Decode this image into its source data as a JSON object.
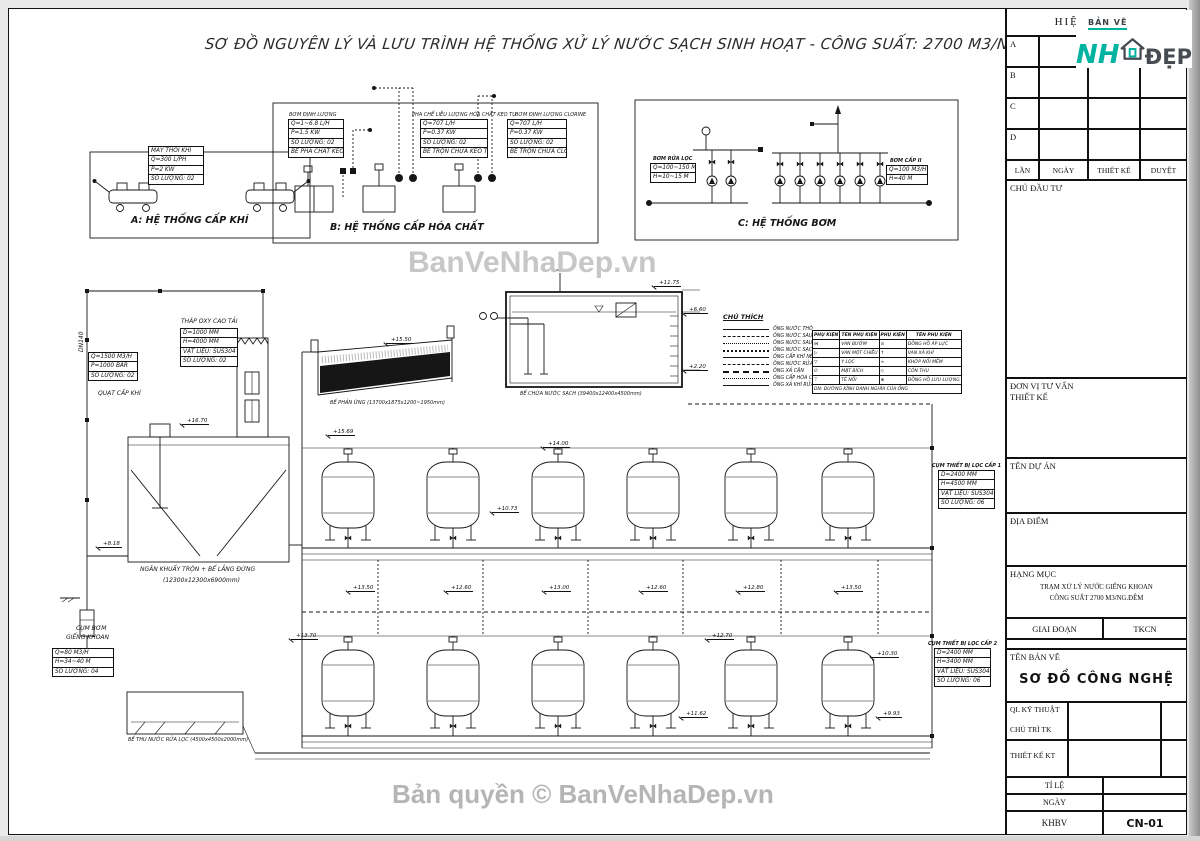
{
  "title": "SƠ ĐỒ NGUYÊN LÝ VÀ LƯU TRÌNH HỆ THỐNG XỬ LÝ NƯỚC SẠCH SINH HOẠT - CÔNG SUẤT: 2700 M3/NGÀY.ĐÊM",
  "watermarks": {
    "center": "BanVeNhaDep.vn",
    "bottom": "Bản quyền © BanVeNhaDep.vn"
  },
  "diagram_a": {
    "caption": "A: HỆ THỐNG CẤP KHÍ",
    "spec": [
      "MÁY THỔI KHÍ",
      "Q=300 L/PH",
      "P=2 KW",
      "SỐ LƯỢNG: 02"
    ]
  },
  "diagram_b": {
    "caption": "B: HỆ THỐNG CẤP HÓA CHẤT",
    "unit1_title": "BƠM ĐỊNH LƯỢNG",
    "unit1": [
      "Q=1~6.8 L/H",
      "P=1.5 KW",
      "SỐ LƯỢNG: 02",
      "BỂ PHA CHẤT KEO TỤ"
    ],
    "unit2_title": "PHA CHẾ LIỀU LƯỢNG HÓA CHẤT KEO TỤ",
    "unit2": [
      "Q=707 L/H",
      "P=0.37 KW",
      "SỐ LƯỢNG: 02",
      "BỂ TRỘN CHỨA KEO TỤ"
    ],
    "unit3_title": "BƠM ĐỊNH LƯỢNG CLORINE",
    "unit3": [
      "Q=707 L/H",
      "P=0.37 KW",
      "SỐ LƯỢNG: 02",
      "BỂ TRỘN CHỨA CLORINE"
    ]
  },
  "diagram_c": {
    "caption": "C: HỆ THỐNG BƠM",
    "left_title": "BƠM RỬA LỌC",
    "left_spec": [
      "Q=100~150 M3/H",
      "H=10~15 M"
    ],
    "right_title": "BƠM CẤP II",
    "right_spec": [
      "Q=100 M3/H",
      "H=40 M"
    ]
  },
  "tower": {
    "label": "THÁP OXY CAO TẢI",
    "spec": [
      "D=1000 MM",
      "H=4000 MM",
      "VẬT LIỆU: SUS304",
      "SỐ LƯỢNG: 02"
    ]
  },
  "fan": {
    "label": "QUẠT CẤP KHÍ",
    "spec": [
      "Q=1500 M3/H",
      "P=1000 BAR",
      "SỐ LƯỢNG: 02"
    ]
  },
  "pipe_dn": "DN140",
  "mixer": {
    "label": "NGĂN KHUẤY TRỘN + BỂ LẮNG ĐỨNG",
    "dims": "(12300x12300x6900mm)"
  },
  "well": {
    "label1": "CỤM BƠM",
    "label2": "GIẾNG KHOAN",
    "spec": [
      "Q=80 M3/H",
      "H=34~40 M",
      "SỐ LƯỢNG: 04"
    ]
  },
  "trough": {
    "label": "BỂ PHẢN ỨNG (13700x1875x1200~1950mm)"
  },
  "clean_tank": {
    "label": "BỂ CHỨA NƯỚC SẠCH (39400x12400x4500mm)"
  },
  "wash_basin": {
    "label": "BỂ THU NƯỚC RỬA LỌC (4500x4500x2000mm)"
  },
  "legend": {
    "title": "CHÚ THÍCH",
    "items": [
      "ỐNG NƯỚC THÔ",
      "ỐNG NƯỚC SAU LÀM THOÁNG",
      "ỐNG NƯỚC SAU LẮNG",
      "ỐNG NƯỚC SẠCH SAU LỌC",
      "ỐNG CẤP KHÍ NÉN",
      "ỐNG NƯỚC RỬA LỌC",
      "ỐNG XẢ CẶN",
      "ỐNG CẤP HÓA CHẤT",
      "ỐNG XẢ KHÍ RỬA LỌC"
    ]
  },
  "fittings": {
    "headers": [
      "PHỤ KIỆN",
      "TÊN PHỤ KIỆN",
      "PHỤ KIỆN",
      "TÊN PHỤ KIỆN"
    ],
    "rows": [
      [
        "⋈",
        "VAN BƯỚM",
        "⊙",
        "ĐỒNG HỒ ÁP LỰC"
      ],
      [
        "▷",
        "VAN MỘT CHIỀU",
        "↑",
        "VAN XẢ KHÍ"
      ],
      [
        "▽",
        "Y LỌC",
        "≈",
        "KHỚP NỐI MỀM"
      ],
      [
        "∅",
        "MẶT BÍCH",
        "◇",
        "CÔN THU"
      ],
      [
        "⊤",
        "TÊ NỐI",
        "⊗",
        "ĐỒNG HỒ LƯU LƯỢNG"
      ]
    ],
    "note": "DN: ĐƯỜNG KÍNH DANH NGHĨA CỦA ỐNG"
  },
  "cluster1": {
    "label": "CỤM THIẾT BỊ LỌC CẤP 1",
    "spec": [
      "D=2400 MM",
      "H=4500 MM",
      "VẬT LIỆU: SUS304",
      "SỐ LƯỢNG: 06"
    ]
  },
  "cluster2": {
    "label": "CỤM THIẾT BỊ LỌC CẤP 2",
    "spec": [
      "D=2400 MM",
      "H=3400 MM",
      "VẬT LIỆU: SUS304",
      "SỐ LƯỢNG: 06"
    ]
  },
  "markers": [
    "+11.75",
    "+6.60",
    "+2.20",
    "+15.50",
    "+16.70",
    "+15.69",
    "+8.18",
    "+14.00",
    "+10.73",
    "+13.50",
    "+12.60",
    "+13.00",
    "+12.60",
    "+12.80",
    "+13.50",
    "+13.70",
    "+12.70",
    "+10.30",
    "+11.62",
    "+9.93"
  ],
  "titleblock": {
    "revision_header": "HIỆU CHỈNH",
    "rows": [
      "A",
      "B",
      "C",
      "D"
    ],
    "cols": [
      "LẦN",
      "NGÀY",
      "THIẾT KẾ",
      "DUYỆT"
    ],
    "investor": "CHỦ ĐẦU TƯ",
    "consultant1": "ĐƠN VỊ TƯ VẤN",
    "consultant2": "THIẾT KẾ",
    "project": "TÊN DỰ ÁN",
    "location": "ĐỊA ĐIỂM",
    "category": "HẠNG MỤC",
    "category_line1": "TRẠM XỬ LÝ NƯỚC GIẾNG KHOAN",
    "category_line2": "CÔNG SUẤT 2700 M3/NG.ĐÊM",
    "stage_label": "GIAI ĐOẠN",
    "stage_value": "TKCN",
    "drawing_name_label": "TÊN BẢN VẼ",
    "drawing_name": "SƠ ĐỒ CÔNG NGHỆ",
    "sig1": "QL KỸ THUẬT",
    "sig2": "CHỦ TRÌ TK",
    "sig3": "THIẾT KẾ KT",
    "scale_label": "TỈ LỆ",
    "date_label": "NGÀY",
    "khbv": "KHBV",
    "sheet_no": "CN-01",
    "logo_top": "BẢN VẼ",
    "logo_nh": "NH",
    "logo_dep": "ĐẸP",
    "logo_teal": "#00b3a1"
  }
}
